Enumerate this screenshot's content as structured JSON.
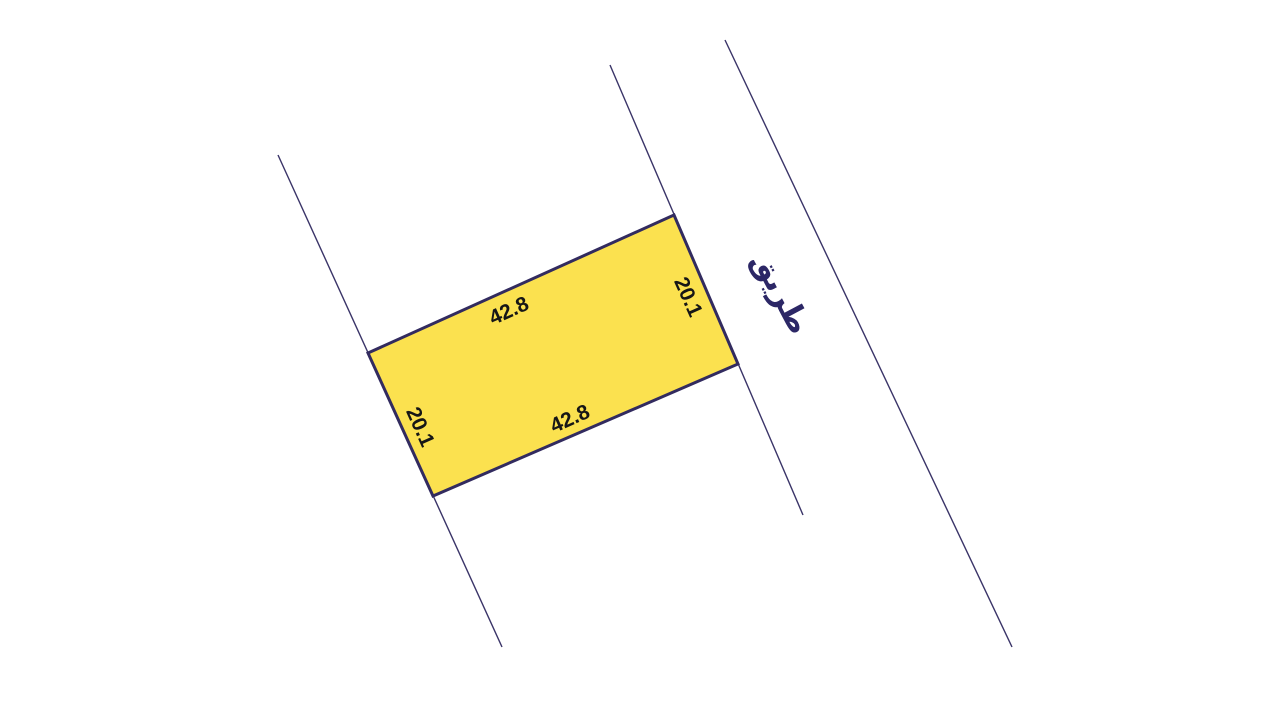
{
  "canvas": {
    "width": 1280,
    "height": 720,
    "background": "#ffffff"
  },
  "palette": {
    "plot_fill": "#FBE14F",
    "plot_stroke": "#322B5F",
    "boundary_line_color": "#3A3468",
    "dimension_text_color": "#161616",
    "road_label_color": "#2C2766"
  },
  "plot": {
    "polygon_points": "674,215 738,364 433,496 368,353",
    "dimension_labels": {
      "top": {
        "text": "42.8",
        "x": 509,
        "y": 311,
        "transform": "rotate(-24 509 311)"
      },
      "right": {
        "text": "20.1",
        "x": 688,
        "y": 297,
        "transform": "rotate(66 688 297)"
      },
      "bottom": {
        "text": "42.8",
        "x": 570,
        "y": 419,
        "transform": "rotate(-24 570 419)"
      },
      "left": {
        "text": "20.1",
        "x": 420,
        "y": 427,
        "transform": "rotate(66 420 427)"
      }
    }
  },
  "boundary_lines": {
    "left": {
      "x1": 278,
      "y1": 155,
      "x2": 502,
      "y2": 647
    },
    "road_inner": {
      "x1": 610,
      "y1": 65,
      "x2": 803,
      "y2": 515
    },
    "road_outer": {
      "x1": 725,
      "y1": 40,
      "x2": 1012,
      "y2": 647
    }
  },
  "road": {
    "label": "طريق",
    "x": 781,
    "y": 293,
    "transform": "rotate(62 781 293)"
  }
}
